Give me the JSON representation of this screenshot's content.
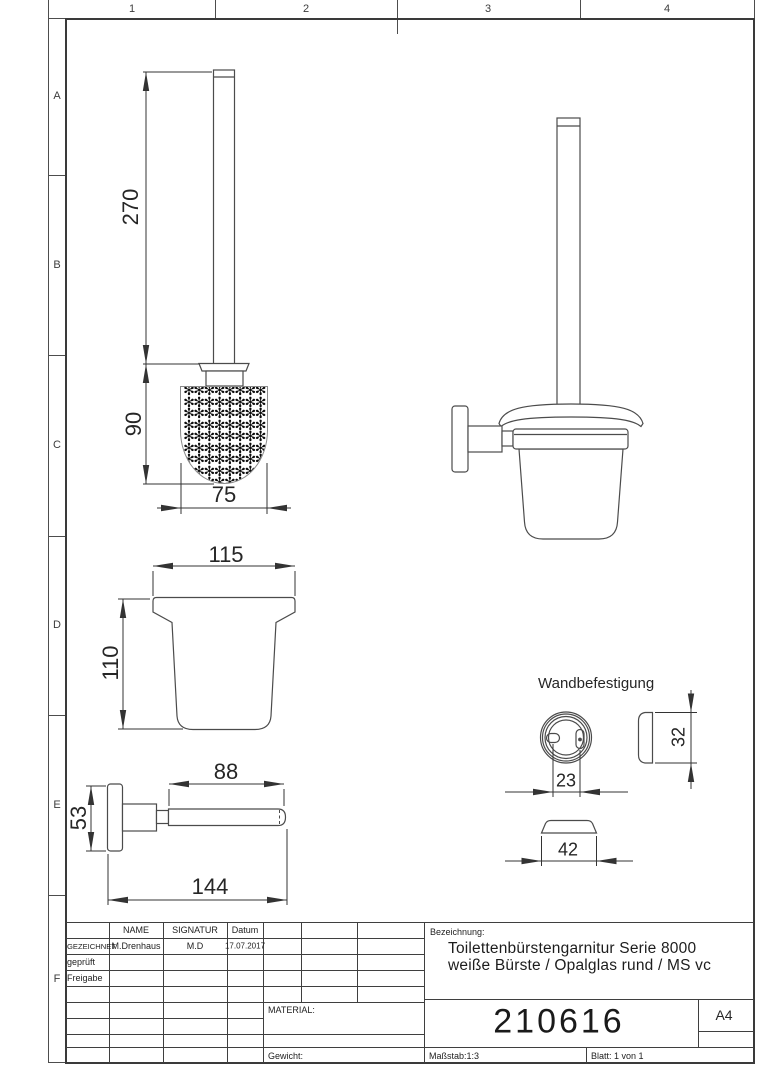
{
  "grid": {
    "columns": [
      "1",
      "2",
      "3",
      "4"
    ],
    "rows": [
      "A",
      "B",
      "C",
      "D",
      "E",
      "F"
    ]
  },
  "views": {
    "brush_front": {
      "dim_handle_height": "270",
      "dim_brush_height": "90",
      "dim_brush_width": "75",
      "bristles": "✻✻✻✻✻✻✻✻\n✻✻✻✻✻✻✻✻\n✻✻✻✻✻✻✻✻\n✻✻✻✻✻✻✻✻\n✻✻✻✻✻✻✻✻\n✻✻✻✻✻✻✻✻\n✻✻✻✻✻✻✻✻\n✻✻✻✻✻✻✻✻\n✻✻✻✻✻✻✻✻"
    },
    "glass_front": {
      "dim_width": "115",
      "dim_height": "110"
    },
    "holder_side": {
      "dim_rod_length": "88",
      "dim_plate_height": "53",
      "dim_total_length": "144"
    },
    "wall_mount": {
      "title": "Wandbefestigung",
      "dim_hole_spacing": "23",
      "dim_plate_height": "32",
      "dim_cap_width": "42"
    }
  },
  "title_block": {
    "header": {
      "name": "NAME",
      "signatur": "SIGNATUR",
      "datum": "Datum"
    },
    "rows": [
      {
        "label": "GEZEICHNET",
        "name": "M.Drenhaus",
        "signatur": "M.D",
        "datum": "17.07.2017"
      },
      {
        "label": "geprüft"
      },
      {
        "label": "Freigabe"
      }
    ],
    "material_label": "MATERIAL:",
    "gewicht_label": "Gewicht:",
    "bezeichnung_label": "Bezeichnung:",
    "title_line1": "Toilettenbürstengarnitur Serie 8000",
    "title_line2": "weiße Bürste / Opalglas rund / MS vc",
    "part_number": "210616",
    "format": "A4",
    "massstab": "Maßstab:1:3",
    "blatt": "Blatt: 1 von 1"
  }
}
